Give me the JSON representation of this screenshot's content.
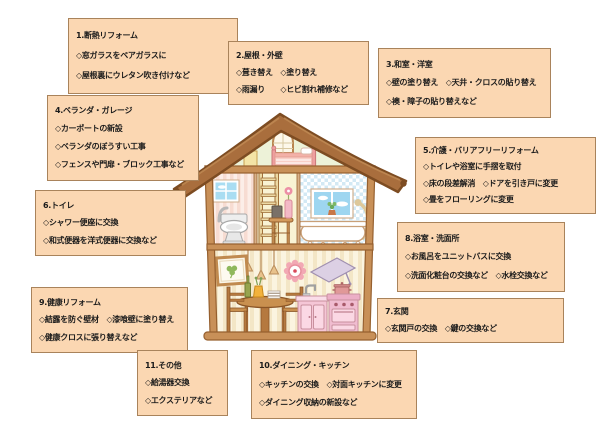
{
  "palette": {
    "box_fill": "#fbd7b2",
    "box_border": "#a9835b",
    "text": "#1b1b1b",
    "roof_brown": "#a96e3d",
    "beam_brown": "#c89058",
    "attic_green": "#edf2d8",
    "toilet_pink_wall": "#f7dcd2",
    "bath_check_blue": "#d3e9f4",
    "dining_cream": "#f3e6c6",
    "kitchen_pink": "#f5c6d6"
  },
  "boxes": [
    {
      "title": "1.断熱リフォーム",
      "lines": [
        "◇窓ガラスをペアガラスに",
        "◇屋根裏にウレタン吹き付けなど"
      ]
    },
    {
      "title": "2.屋根・外壁",
      "lines": [
        "◇葺き替え　◇塗り替え",
        "◇雨漏り　　◇ヒビ割れ補修など"
      ]
    },
    {
      "title": "3.和室・洋室",
      "lines": [
        "◇壁の塗り替え　◇天井・クロスの貼り替え",
        "◇襖・障子の貼り替えなど"
      ]
    },
    {
      "title": "4.ベランダ・ガレージ",
      "lines": [
        "◇カーポートの新設",
        "◇ベランダのぼうすい工事",
        "◇フェンスや門扉・ブロック工事など"
      ]
    },
    {
      "title": "5.介護・バリアフリーリフォーム",
      "lines": [
        "◇トイレや浴室に手摺を取付",
        "◇床の段差解消　◇ドアを引き戸に変更",
        "◇畳をフローリングに変更"
      ]
    },
    {
      "title": "6.トイレ",
      "lines": [
        "◇シャワー便座に交換",
        "◇和式便器を洋式便器に交換など"
      ]
    },
    {
      "title": "7.玄関",
      "lines": [
        "◇玄関戸の交換　◇鍵の交換など"
      ]
    },
    {
      "title": "8.浴室・洗面所",
      "lines": [
        "◇お風呂をユニットバスに交換",
        "◇洗面化粧台の交換など　◇水栓交換など"
      ]
    },
    {
      "title": "9.健康リフォーム",
      "lines": [
        "◇結露を防ぐ壁材　◇漆喰壁に塗り替え",
        "◇健康クロスに張り替えなど"
      ]
    },
    {
      "title": "10.ダイニング・キッチン",
      "lines": [
        "◇キッチンの交換　◇対面キッチンに変更",
        "◇ダイニング収納の新設など"
      ]
    },
    {
      "title": "11.その他",
      "lines": [
        "◇給湯器交換",
        "◇エクステリアなど"
      ]
    }
  ],
  "house": {
    "type": "cross-section-illustration",
    "parts": [
      "roof",
      "attic-bedroom",
      "toilet-room",
      "ladder-room",
      "bathroom",
      "dining-room",
      "kitchen"
    ]
  }
}
